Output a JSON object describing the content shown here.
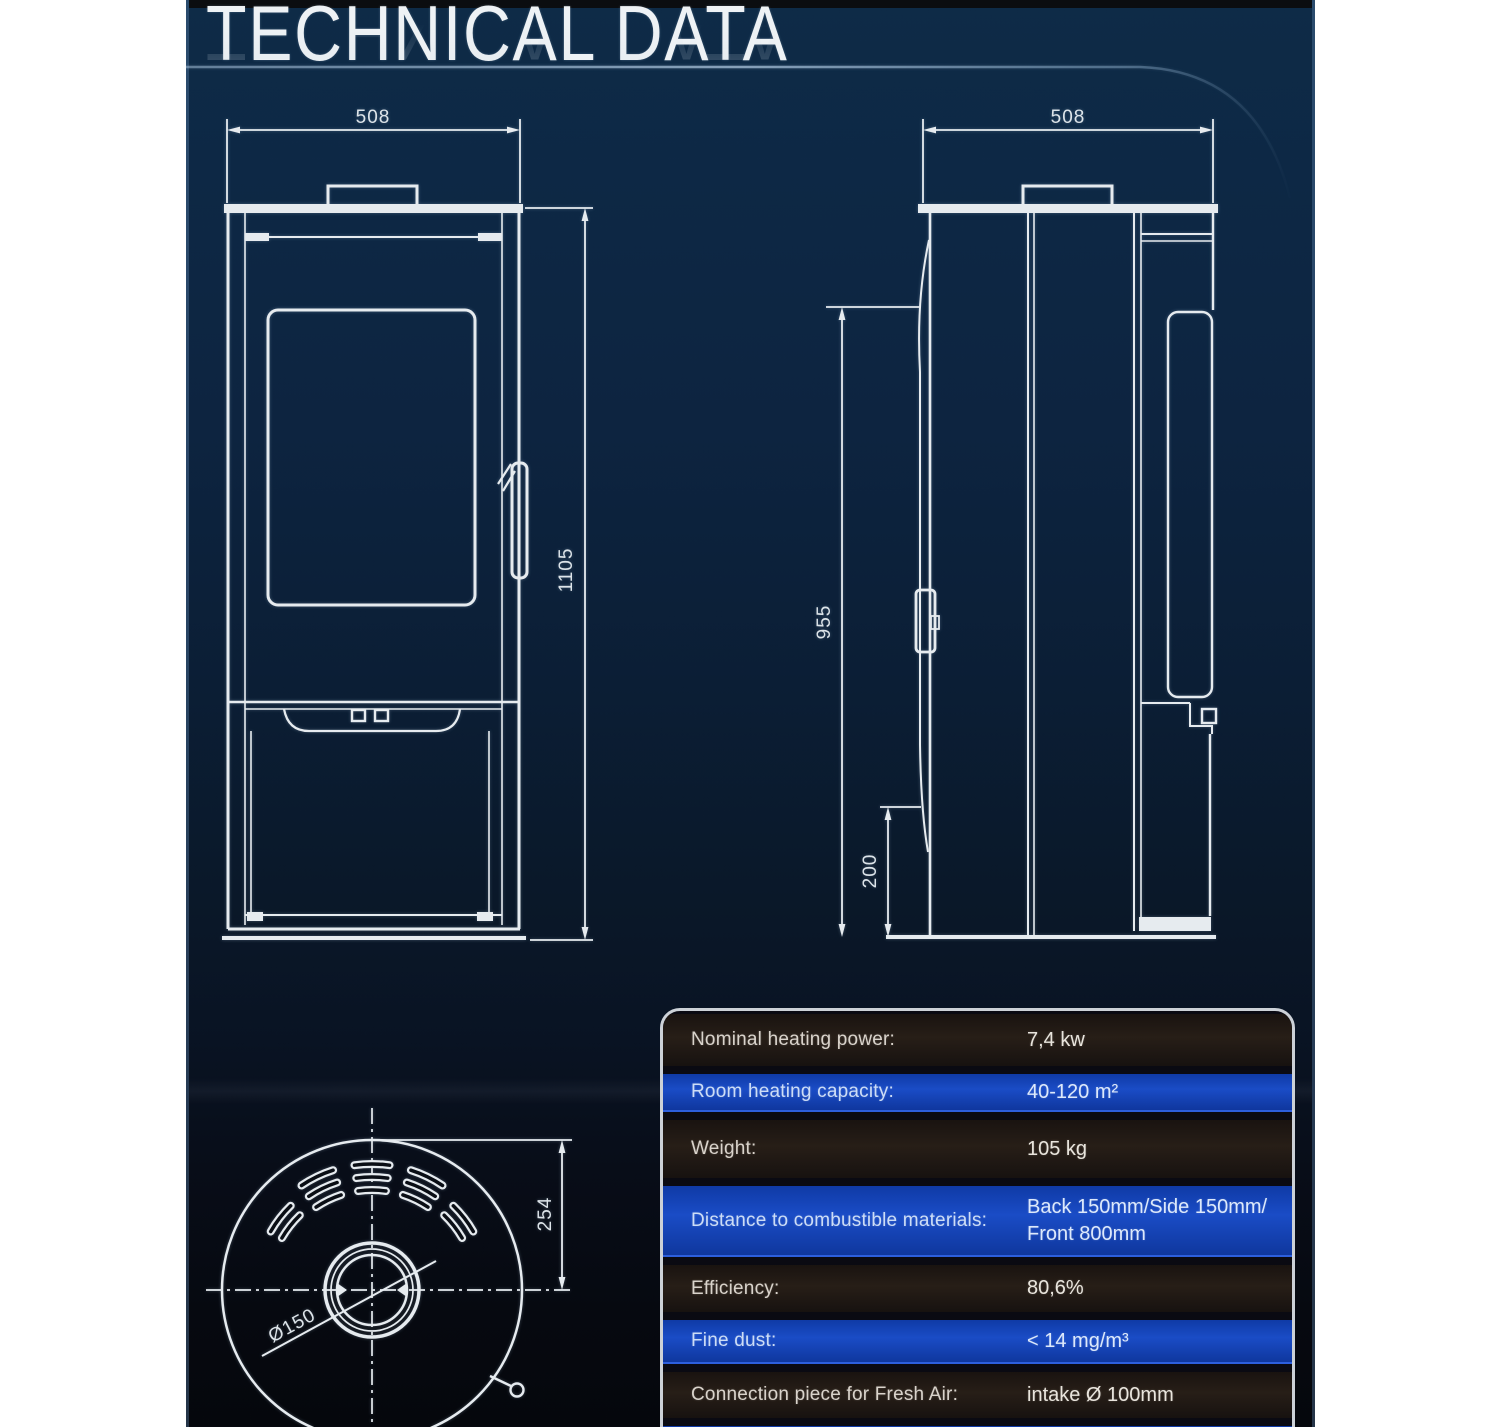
{
  "page": {
    "title": "TECHNICAL DATA"
  },
  "drawings": {
    "front_view": {
      "width_mm": "508",
      "height_mm": "1105"
    },
    "side_view": {
      "depth_mm": "508",
      "height_mm": "955",
      "base_height_mm": "200"
    },
    "top_view": {
      "radius_mm": "254",
      "flue_diameter": "Ø150"
    }
  },
  "table": {
    "rows": [
      {
        "label": "Nominal heating power:",
        "value": "7,4 kw"
      },
      {
        "label": "Room heating capacity:",
        "value": "40-120 m²"
      },
      {
        "label": "Weight:",
        "value": "105 kg"
      },
      {
        "label": "Distance to combustible materials:",
        "value": "Back 150mm/Side 150mm/",
        "value2": "Front 800mm"
      },
      {
        "label": "Efficiency:",
        "value": "80,6%"
      },
      {
        "label": "Fine dust:",
        "value": "< 14 mg/m³"
      },
      {
        "label": "Connection piece for Fresh Air:",
        "value": "intake Ø 100mm"
      }
    ]
  }
}
